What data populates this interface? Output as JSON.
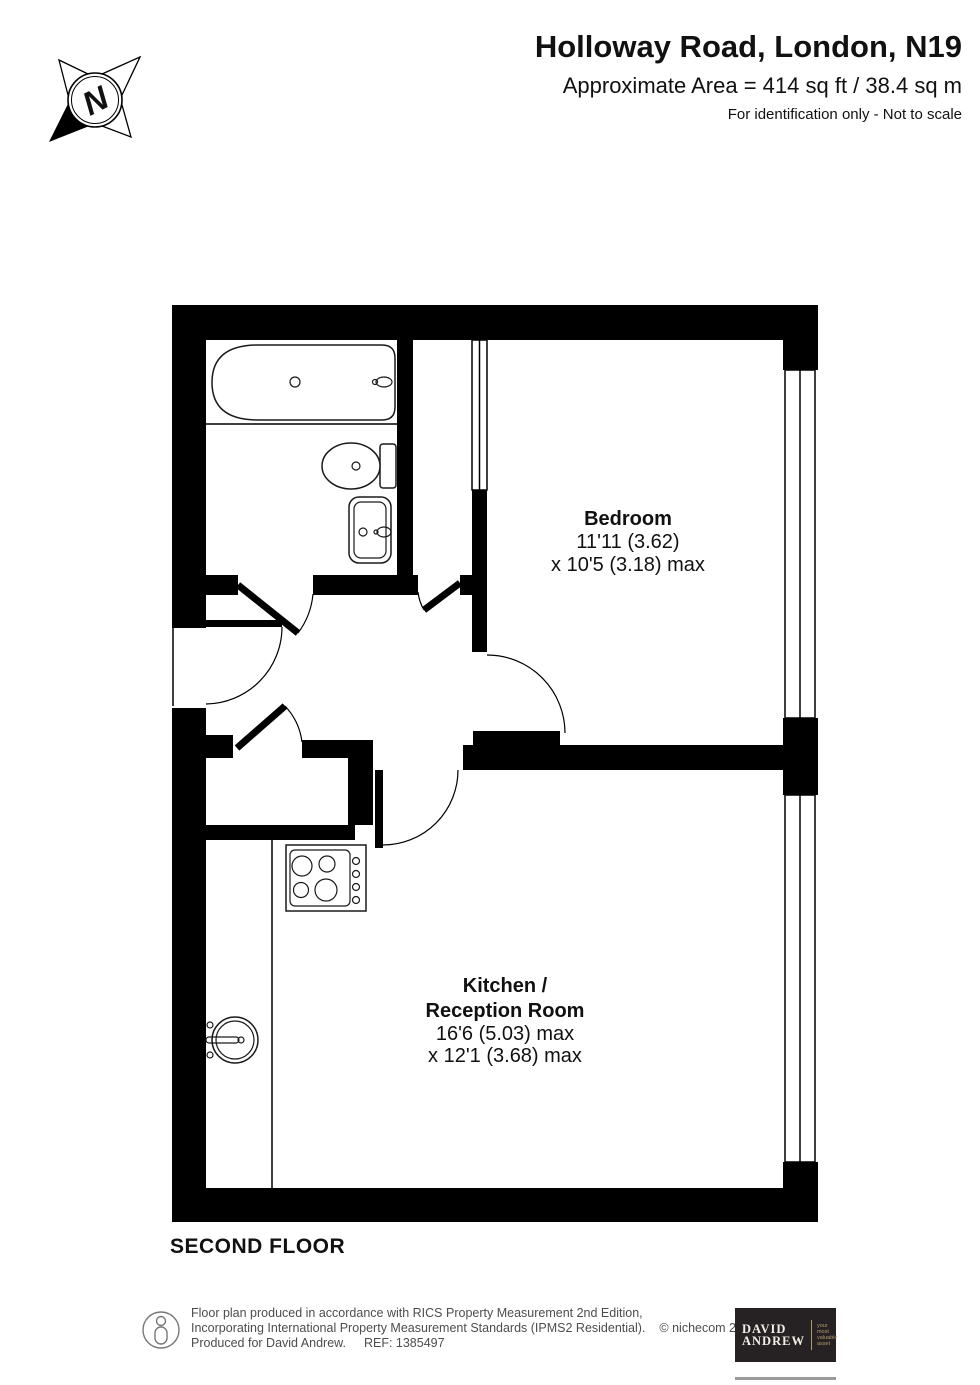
{
  "header": {
    "title": "Holloway Road, London, N19",
    "area": "Approximate Area = 414 sq ft / 38.4 sq m",
    "disclaimer": "For identification only - Not to scale"
  },
  "compass": {
    "label": "N"
  },
  "floor_label": "SECOND FLOOR",
  "rooms": {
    "bedroom": {
      "name": "Bedroom",
      "dim1": "11'11 (3.62)",
      "dim2": "x 10'5 (3.18) max"
    },
    "kitchen_reception": {
      "name_line1": "Kitchen /",
      "name_line2": "Reception Room",
      "dim1": "16'6 (5.03) max",
      "dim2": "x 12'1 (3.68) max"
    }
  },
  "icons": {
    "compass": "compass-rose-icon",
    "person": "person-icon",
    "fixtures": [
      "bathtub-icon",
      "toilet-icon",
      "basin-icon",
      "hob-icon",
      "kitchen-sink-icon",
      "window-glyph",
      "door-arc-glyph"
    ]
  },
  "footer": {
    "line1": "Floor plan produced in accordance with RICS Property Measurement 2nd Edition,",
    "line2": "Incorporating International Property Measurement Standards (IPMS2 Residential).",
    "copyright": "© nichecom 2025.",
    "line3": "Produced for David Andrew.",
    "ref": "REF: 1385497"
  },
  "logo": {
    "name_line1": "DAVID",
    "name_line2": "ANDREW",
    "tagline_lines": [
      "your",
      "most",
      "valuable",
      "asset"
    ]
  },
  "colors": {
    "wall": "#000000",
    "footer_text": "#4d4d4d",
    "logo_background": "#262123",
    "logo_accent": "#b09a6d"
  }
}
